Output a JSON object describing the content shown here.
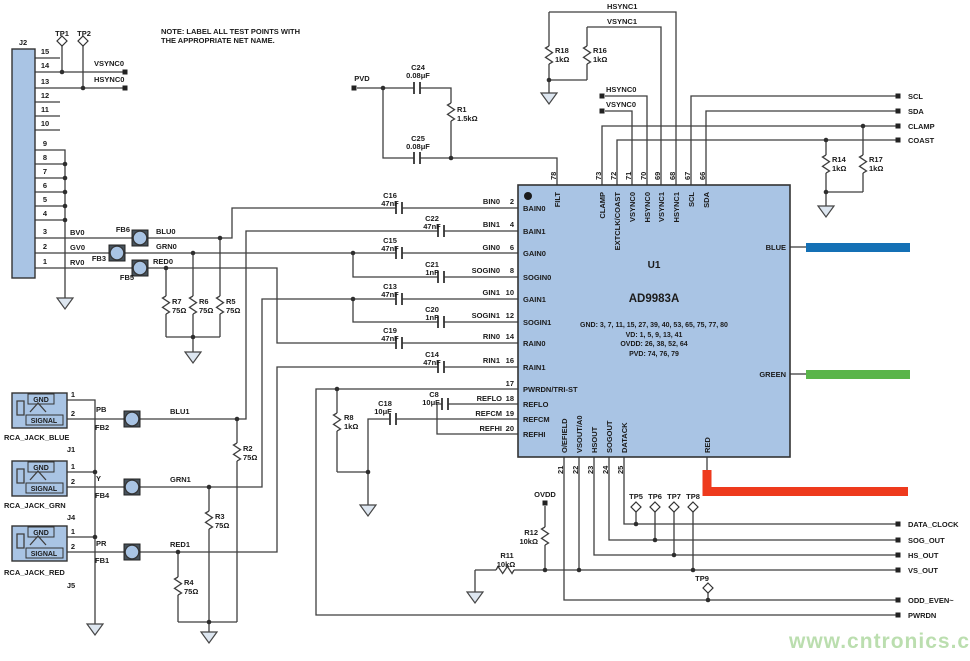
{
  "note_line1": "NOTE: LABEL ALL TEST POINTS WITH",
  "note_line2": "THE APPROPRIATE NET NAME.",
  "watermark": "www.cntronics.com",
  "colors": {
    "chip_fill": "#a9c4e4",
    "wire": "#3f3f3f",
    "blue_bar": "#1470b5",
    "green_bar": "#5ab54a",
    "red_bar": "#ee3a1d",
    "watermark_green": "#abd79c"
  },
  "chip": {
    "ref": "U1",
    "part": "AD9983A",
    "power": [
      "GND: 3, 7, 11, 15, 27, 39, 40, 53, 65, 75, 77, 80",
      "VD: 1, 5, 9, 13, 41",
      "OVDD: 26, 38, 52, 64",
      "PVD: 74, 76, 79"
    ],
    "top": [
      {
        "num": "78",
        "name": "FILT"
      },
      {
        "num": "73",
        "name": "CLAMP"
      },
      {
        "num": "72",
        "name": "EXTCLK/COAST"
      },
      {
        "num": "71",
        "name": "VSYNC0"
      },
      {
        "num": "70",
        "name": "HSYNC0"
      },
      {
        "num": "69",
        "name": "VSYNC1"
      },
      {
        "num": "68",
        "name": "HSYNC1"
      },
      {
        "num": "67",
        "name": "SCL"
      },
      {
        "num": "66",
        "name": "SDA"
      }
    ],
    "left": [
      {
        "num": "2",
        "name": "BAIN0"
      },
      {
        "num": "4",
        "name": "BAIN1"
      },
      {
        "num": "6",
        "name": "GAIN0"
      },
      {
        "num": "8",
        "name": "SOGIN0"
      },
      {
        "num": "10",
        "name": "GAIN1"
      },
      {
        "num": "12",
        "name": "SOGIN1"
      },
      {
        "num": "14",
        "name": "RAIN0"
      },
      {
        "num": "16",
        "name": "RAIN1"
      },
      {
        "num": "17",
        "name": "PWRDN/TRI-ST"
      },
      {
        "num": "18",
        "name": "REFLO"
      },
      {
        "num": "19",
        "name": "REFCM"
      },
      {
        "num": "20",
        "name": "REFHI"
      }
    ],
    "bottom": [
      {
        "num": "21",
        "name": "O/EFIELD"
      },
      {
        "num": "22",
        "name": "VSOUT/A0"
      },
      {
        "num": "23",
        "name": "HSOUT"
      },
      {
        "num": "24",
        "name": "SOGOUT"
      },
      {
        "num": "25",
        "name": "DATACK"
      }
    ],
    "right": {
      "blue": "BLUE",
      "green": "GREEN",
      "red": "RED"
    }
  },
  "j2": {
    "ref": "J2",
    "pins": [
      "15",
      "14",
      "13",
      "12",
      "11",
      "10",
      "9",
      "8",
      "7",
      "6",
      "5",
      "4",
      "3",
      "2",
      "1"
    ]
  },
  "jacks": {
    "j1": {
      "ref": "J1",
      "name": "RCA_JACK_BLUE",
      "gnd": "GND",
      "signal": "SIGNAL",
      "p1": "1",
      "p2": "2",
      "net": "PB"
    },
    "j4": {
      "ref": "J4",
      "name": "RCA_JACK_GRN",
      "gnd": "GND",
      "signal": "SIGNAL",
      "p1": "1",
      "p2": "2",
      "net": "Y"
    },
    "j5": {
      "ref": "J5",
      "name": "RCA_JACK_RED",
      "gnd": "GND",
      "signal": "SIGNAL",
      "p1": "1",
      "p2": "2",
      "net": "PR"
    }
  },
  "beads": {
    "fb1": "FB1",
    "fb2": "FB2",
    "fb3": "FB3",
    "fb4": "FB4",
    "fb5": "FB5",
    "fb6": "FB6"
  },
  "resistors": {
    "r1": {
      "ref": "R1",
      "value": "1.5kΩ"
    },
    "r2": {
      "ref": "R2",
      "value": "75Ω"
    },
    "r3": {
      "ref": "R3",
      "value": "75Ω"
    },
    "r4": {
      "ref": "R4",
      "value": "75Ω"
    },
    "r5": {
      "ref": "R5",
      "value": "75Ω"
    },
    "r6": {
      "ref": "R6",
      "value": "75Ω"
    },
    "r7": {
      "ref": "R7",
      "value": "75Ω"
    },
    "r8": {
      "ref": "R8",
      "value": "1kΩ"
    },
    "r11": {
      "ref": "R11",
      "value": "10kΩ"
    },
    "r12": {
      "ref": "R12",
      "value": "10kΩ"
    },
    "r14": {
      "ref": "R14",
      "value": "1kΩ"
    },
    "r16": {
      "ref": "R16",
      "value": "1kΩ"
    },
    "r17": {
      "ref": "R17",
      "value": "1kΩ"
    },
    "r18": {
      "ref": "R18",
      "value": "1kΩ"
    }
  },
  "capacitors": {
    "c8": {
      "ref": "C8",
      "value": "10μF"
    },
    "c13": {
      "ref": "C13",
      "value": "47nF"
    },
    "c14": {
      "ref": "C14",
      "value": "47nF"
    },
    "c15": {
      "ref": "C15",
      "value": "47nF"
    },
    "c16": {
      "ref": "C16",
      "value": "47nF"
    },
    "c18": {
      "ref": "C18",
      "value": "10μF"
    },
    "c19": {
      "ref": "C19",
      "value": "47nF"
    },
    "c20": {
      "ref": "C20",
      "value": "1nF"
    },
    "c21": {
      "ref": "C21",
      "value": "1nF"
    },
    "c22": {
      "ref": "C22",
      "value": "47nF"
    },
    "c24": {
      "ref": "C24",
      "value": "0.08μF"
    },
    "c25": {
      "ref": "C25",
      "value": "0.08μF"
    }
  },
  "testpoints": {
    "tp1": "TP1",
    "tp2": "TP2",
    "tp5": "TP5",
    "tp6": "TP6",
    "tp7": "TP7",
    "tp8": "TP8",
    "tp9": "TP9"
  },
  "nets": {
    "vsync0": "VSYNC0",
    "hsync0": "HSYNC0",
    "hsync1": "HSYNC1",
    "vsync1": "VSYNC1",
    "bv0": "BV0",
    "gv0": "GV0",
    "rv0": "RV0",
    "blu0": "BLU0",
    "grn0": "GRN0",
    "red0": "RED0",
    "blu1": "BLU1",
    "grn1": "GRN1",
    "red1": "RED1",
    "bin0": "BIN0",
    "bin1": "BIN1",
    "gin0": "GIN0",
    "sogin0": "SOGIN0",
    "gin1": "GIN1",
    "sogin1": "SOGIN1",
    "rin0": "RIN0",
    "rin1": "RIN1",
    "reflo": "REFLO",
    "refcm": "REFCM",
    "refhi": "REFHI"
  },
  "ports": {
    "pvd": "PVD",
    "ovdd": "OVDD",
    "scl": "SCL",
    "sda": "SDA",
    "clamp": "CLAMP",
    "coast": "COAST",
    "data_clock": "DATA_CLOCK",
    "sog_out": "SOG_OUT",
    "hs_out": "HS_OUT",
    "vs_out": "VS_OUT",
    "odd_even": "ODD_EVEN~",
    "pwrdn": "PWRDN"
  }
}
